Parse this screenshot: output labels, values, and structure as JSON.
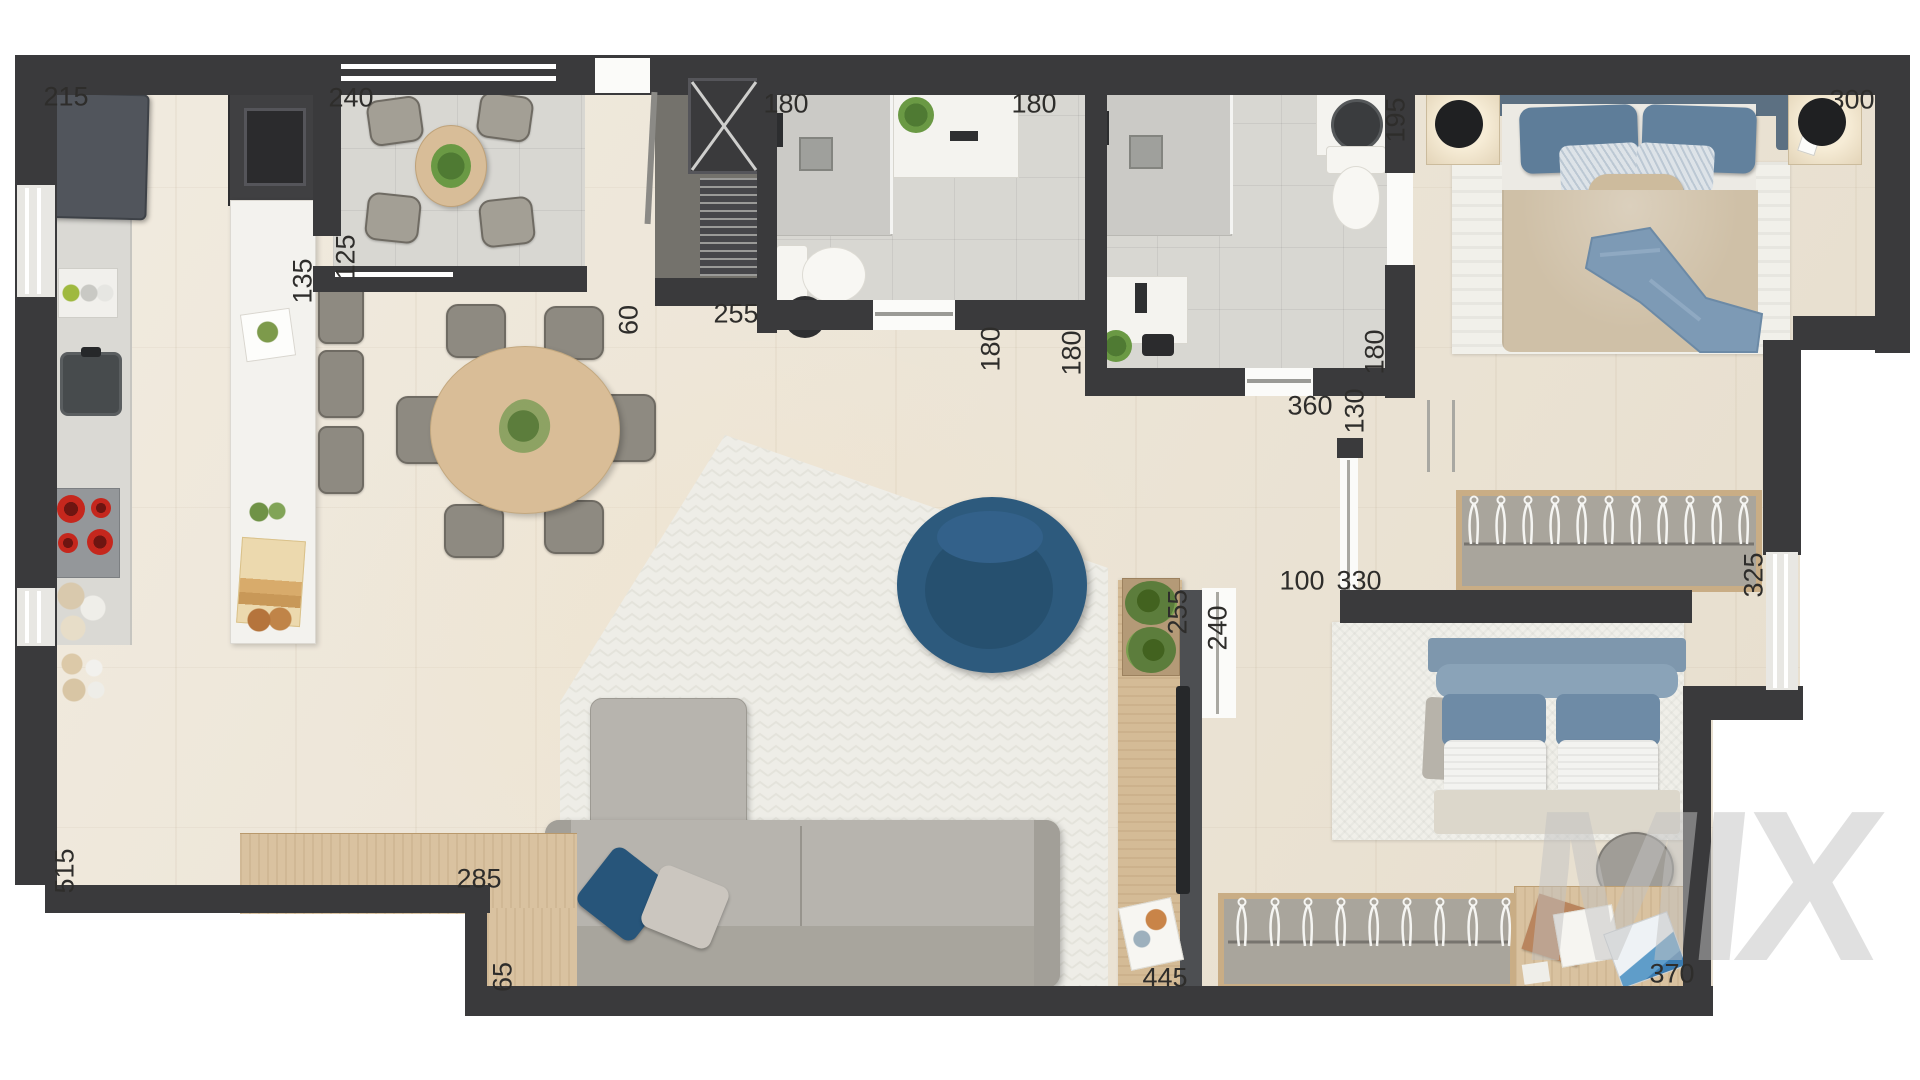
{
  "watermark": {
    "text": "MIX"
  },
  "colors": {
    "wall": "#3a3a3c",
    "floor_wood": "#ebe2d1",
    "tile_gray": "#d8d7d2",
    "furniture_wood": "#d9c2a0",
    "accent_blue": "#2d5a7d",
    "bed_blue": "#5e7d99",
    "duvet_beige": "#cfc0a7",
    "sofa_gray": "#b7b4ae",
    "burner_red": "#c5271d",
    "plant_green": "#5c7d3c",
    "label_text": "#2e2d2b",
    "watermark_gray": "#c6c6c6"
  },
  "dimension_labels": [
    {
      "text": "215",
      "cx": 66,
      "cy": 97,
      "vertical": false
    },
    {
      "text": "240",
      "cx": 351,
      "cy": 98,
      "vertical": false
    },
    {
      "text": "125",
      "cx": 346,
      "cy": 257,
      "vertical": true
    },
    {
      "text": "135",
      "cx": 303,
      "cy": 281,
      "vertical": true
    },
    {
      "text": "180",
      "cx": 786,
      "cy": 104,
      "vertical": false
    },
    {
      "text": "180",
      "cx": 1034,
      "cy": 104,
      "vertical": false
    },
    {
      "text": "195",
      "cx": 1396,
      "cy": 120,
      "vertical": true
    },
    {
      "text": "300",
      "cx": 1852,
      "cy": 100,
      "vertical": false
    },
    {
      "text": "255",
      "cx": 736,
      "cy": 314,
      "vertical": false
    },
    {
      "text": "60",
      "cx": 629,
      "cy": 320,
      "vertical": true
    },
    {
      "text": "180",
      "cx": 991,
      "cy": 349,
      "vertical": true
    },
    {
      "text": "180",
      "cx": 1072,
      "cy": 353,
      "vertical": true
    },
    {
      "text": "180",
      "cx": 1375,
      "cy": 352,
      "vertical": true
    },
    {
      "text": "360",
      "cx": 1310,
      "cy": 406,
      "vertical": false
    },
    {
      "text": "130",
      "cx": 1355,
      "cy": 411,
      "vertical": true
    },
    {
      "text": "100",
      "cx": 1302,
      "cy": 581,
      "vertical": false
    },
    {
      "text": "330",
      "cx": 1359,
      "cy": 581,
      "vertical": false
    },
    {
      "text": "325",
      "cx": 1754,
      "cy": 575,
      "vertical": true
    },
    {
      "text": "255",
      "cx": 1178,
      "cy": 612,
      "vertical": true
    },
    {
      "text": "240",
      "cx": 1218,
      "cy": 628,
      "vertical": true
    },
    {
      "text": "515",
      "cx": 65,
      "cy": 871,
      "vertical": true
    },
    {
      "text": "285",
      "cx": 479,
      "cy": 879,
      "vertical": false
    },
    {
      "text": "65",
      "cx": 503,
      "cy": 977,
      "vertical": true
    },
    {
      "text": "445",
      "cx": 1165,
      "cy": 978,
      "vertical": false
    },
    {
      "text": "370",
      "cx": 1672,
      "cy": 974,
      "vertical": false
    }
  ]
}
